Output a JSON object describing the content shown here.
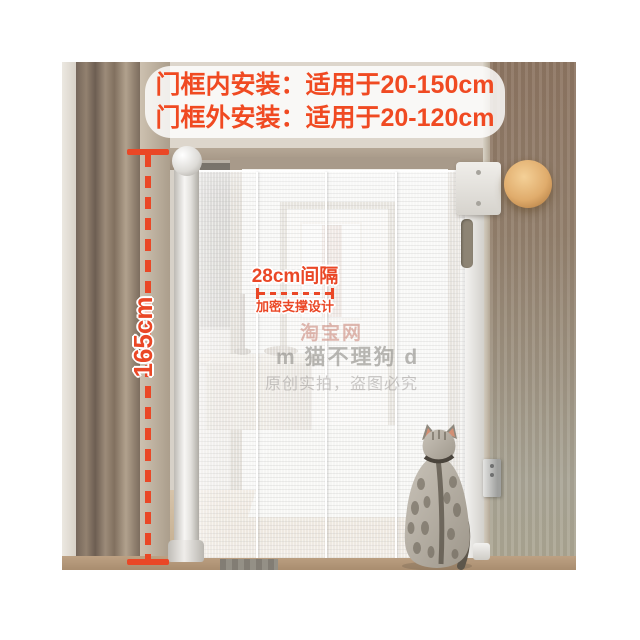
{
  "image_type": "product-photo-with-annotations",
  "colors": {
    "accent": "#ea4726",
    "banner_text": "#f04a22",
    "banner_background": "rgba(255,255,255,0.82)",
    "lamp": "#e0ac6c",
    "wall_wood": "#8d7562"
  },
  "banner": {
    "line1": "门框内安装：适用于20-150cm",
    "line2": "门框外安装：适用于20-120cm"
  },
  "height_measure": {
    "label": "165cm"
  },
  "spacing_note": {
    "title": "28cm间隔",
    "subtitle": "加密支撑设计"
  },
  "watermark": {
    "line1": "淘宝网",
    "line2": "m 猫不理狗 d",
    "line3": "原创实拍，盗图必究"
  }
}
